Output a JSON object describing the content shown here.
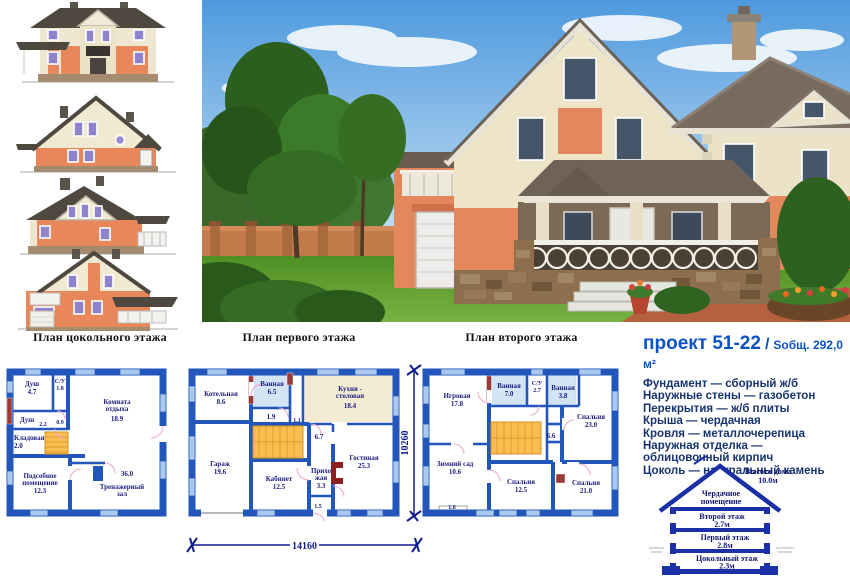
{
  "captions": {
    "basement": "План цокольного этажа",
    "first": "План первого этажа",
    "second": "План второго этажа"
  },
  "project": {
    "title": "проект 51-22",
    "sep": "/",
    "area": "Sобщ. 292,0 м²",
    "specs": [
      "Фундамент — сборный ж/б",
      "Наружные стены — газобетон",
      "Перекрытия — ж/б плиты",
      "Крыша — чердачная",
      "Кровля — металлочерепица",
      "Наружная отделка — облицовочный кирпич",
      "Цоколь — натуральный камень"
    ]
  },
  "dims": {
    "width": "14160",
    "depth": "10260"
  },
  "plan_basement": {
    "dush1": {
      "n": "Душ",
      "a": "4.7"
    },
    "su": {
      "n": "С/У",
      "a": "1.8"
    },
    "dush2": {
      "n": "Душ",
      "a": "2.2"
    },
    "c09": "0.9",
    "klad": {
      "n": "Кладовая",
      "a": "2.0"
    },
    "komnata": {
      "n1": "Комната",
      "n2": "отдыха",
      "a": "18.9"
    },
    "podsob": {
      "n1": "Подсобное",
      "n2": "помещение",
      "a": "12.3"
    },
    "zal": {
      "a": "36.0",
      "n1": "Тренажерный",
      "n2": "зал"
    }
  },
  "plan_first": {
    "kotel": {
      "n": "Котельная",
      "a": "8.6"
    },
    "van": {
      "n": "Ванная",
      "a": "6.5"
    },
    "kuh": {
      "n1": "Кухня -",
      "n2": "столовая",
      "a": "18.4"
    },
    "c19": "1.9",
    "c11": "1.1",
    "c67": "6.7",
    "garage": {
      "n": "Гараж",
      "a": "19.6"
    },
    "kab": {
      "n": "Кабинет",
      "a": "12.5"
    },
    "prih": {
      "n1": "Прихо",
      "n2": "жая",
      "a": "3.3"
    },
    "gost": {
      "n": "Гостиная",
      "a": "25.3"
    },
    "c15": "1.5"
  },
  "plan_second": {
    "igr": {
      "n": "Игровая",
      "a": "17.8"
    },
    "van1": {
      "n": "Ванная",
      "a": "7.0"
    },
    "su": {
      "n": "С/У",
      "a": "2.7"
    },
    "van2": {
      "n": "Ванная",
      "a": "3.8"
    },
    "sp1": {
      "n": "Спальня",
      "a": "23.0"
    },
    "c66": "6.6",
    "zim": {
      "n": "Зимний сад",
      "a": "10.6"
    },
    "sp2": {
      "n": "Спальня",
      "a": "12.5"
    },
    "sp3": {
      "n": "Спальня",
      "a": "21.0"
    },
    "c16": "1.6"
  },
  "section": {
    "height1": "Высота дома",
    "height2": "10.0м",
    "attic1": "Чердачное",
    "attic2": "помещение",
    "f2n": "Второй этаж",
    "f2h": "2.7м",
    "f1n": "Первый этаж",
    "f1h": "2.8м",
    "f0n": "Цокольный этаж",
    "f0h": "2.3м"
  },
  "colors": {
    "wall_blue": "#2356bb",
    "stair_orange": "#f9bd51",
    "accent_blue": "#0b52c8",
    "spec_navy": "#17336f",
    "brick_orange": "#e2885c",
    "roof_gray": "#6f6256"
  }
}
